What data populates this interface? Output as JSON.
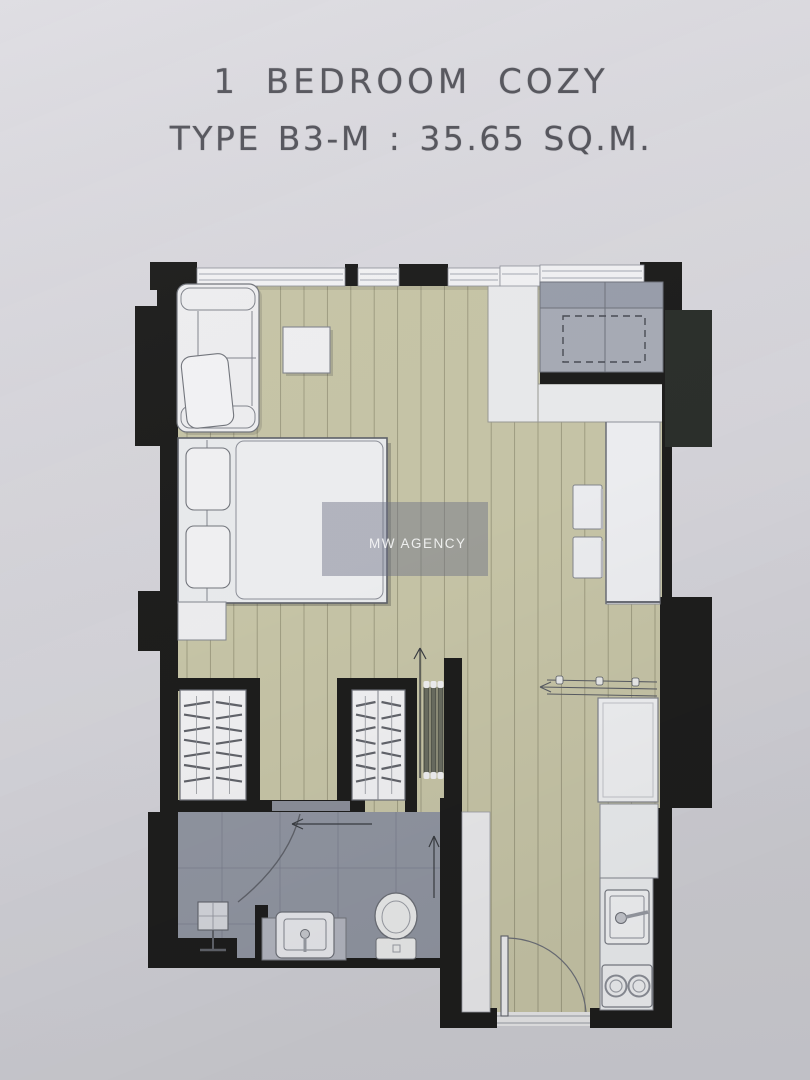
{
  "header": {
    "title": "1 BEDROOM COZY",
    "subtitle": "TYPE B3-M : 35.65 SQ.M."
  },
  "watermark": {
    "label": "MW AGENCY"
  },
  "floorplan": {
    "type": "apartment-floor-plan",
    "unit": {
      "name": "1 Bedroom Cozy",
      "type_code": "B3-M",
      "area_sqm": 35.65
    },
    "colors": {
      "page_background": "#d8d7dd",
      "wall_black": "#1e1e1d",
      "wood_floor": "#c9c7a9",
      "wood_floor_line": "#8e8c72",
      "bathroom_floor": "#9297a3",
      "furniture_white": "#f0f1f3",
      "gray_unit": "#a9adb8",
      "outside_block": "#2c302c",
      "watermark_fill": "rgba(109,112,135,0.45)",
      "title_text": "#56565d"
    },
    "rooms": [
      {
        "name": "bedroom",
        "furniture": [
          "sofa",
          "side-table",
          "double-bed",
          "pillows",
          "nightstand"
        ]
      },
      {
        "name": "wardrobe-area",
        "furniture": [
          "wardrobe-left",
          "wardrobe-right",
          "sliding-door-panels"
        ]
      },
      {
        "name": "bathroom",
        "furniture": [
          "shower",
          "vanity-sink",
          "toilet",
          "sliding-door"
        ]
      },
      {
        "name": "living-kitchen",
        "furniture": [
          "ac-unit-cabinet",
          "counter-desk",
          "stool",
          "stool",
          "drying-rack",
          "refrigerator",
          "kitchen-counter",
          "kitchen-sink",
          "stove-two-burner"
        ]
      },
      {
        "name": "entrance",
        "furniture": [
          "entry-door",
          "shoe-cabinet"
        ]
      }
    ]
  }
}
